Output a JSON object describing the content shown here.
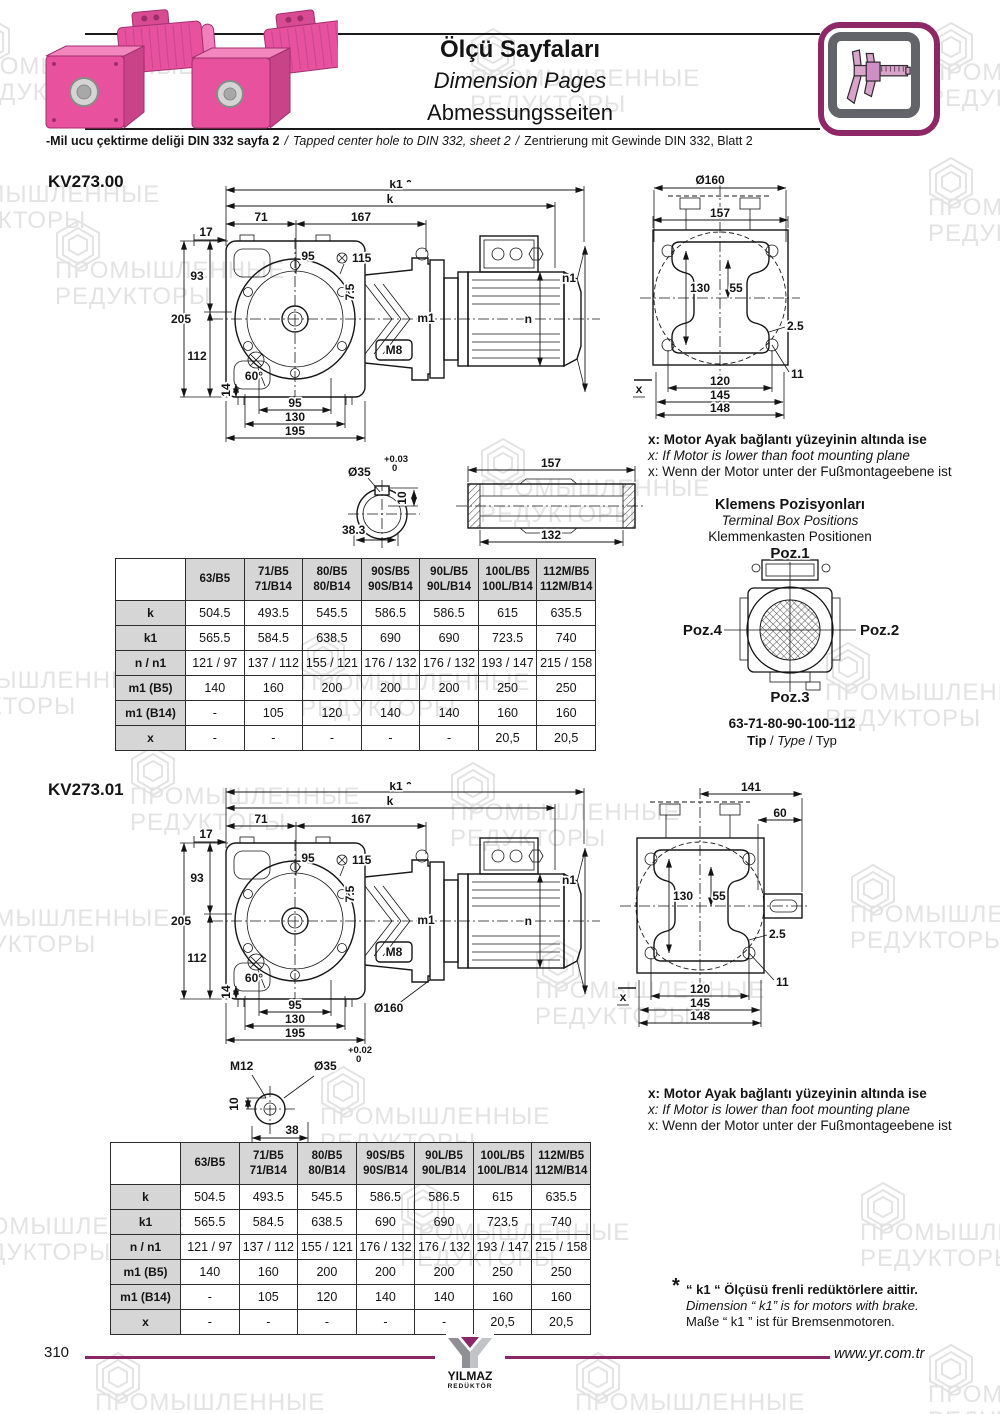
{
  "header": {
    "title_tr": "Ölçü Sayfaları",
    "title_en": "Dimension Pages",
    "title_de": "Abmessungsseiten",
    "note_tr": "-Mil ucu çektirme deliği DIN 332 sayfa 2",
    "note_en": "Tapped center hole to DIN 332, sheet 2",
    "note_de": "Zentrierung mit Gewinde DIN 332, Blatt 2",
    "sep": "/"
  },
  "watermark": {
    "line1": "ПРОМЫШЛЕННЫЕ",
    "line2": "РЕДУКТОРЫ"
  },
  "models": {
    "kv00": {
      "name": "KV273.00",
      "side": {
        "k1": "k1",
        "star": "*",
        "k": "k",
        "d17": "17",
        "d71": "71",
        "d167": "167",
        "d95": "95",
        "d115": "115",
        "d93": "93",
        "d205": "205",
        "d112": "112",
        "d60": "60°",
        "d7_5": "7.5",
        "m8": "M8",
        "m1": "m1",
        "n": "n",
        "n1": "n1",
        "d14": "14",
        "d95b": "95",
        "d130": "130",
        "d195": "195"
      },
      "front": {
        "dia": "Ø160",
        "d157": "157",
        "d130": "130",
        "d55": "55",
        "d2_5": "2.5",
        "d11": "11",
        "d120": "120",
        "d145": "145",
        "d148": "148",
        "x": "x"
      },
      "shaft": {
        "tol_hi": "+0.03",
        "tol_lo": "0",
        "dia": "Ø35",
        "d10": "10",
        "d38": "38.3",
        "d157": "157",
        "d132": "132"
      }
    },
    "kv01": {
      "name": "KV273.01",
      "side": {
        "k1": "k1",
        "star": "*",
        "k": "k",
        "d17": "17",
        "d71": "71",
        "d167": "167",
        "d95": "95",
        "d115": "115",
        "d93": "93",
        "d205": "205",
        "d112": "112",
        "d60": "60°",
        "d7_5": "7.5",
        "m8": "M8",
        "m1": "m1",
        "n": "n",
        "n1": "n1",
        "d14": "14",
        "d95b": "95",
        "d130": "130",
        "d195": "195",
        "dia": "Ø160"
      },
      "front": {
        "d141": "141",
        "d60": "60",
        "d130": "130",
        "d55": "55",
        "d2_5": "2.5",
        "d11": "11",
        "d120": "120",
        "d145": "145",
        "d148": "148",
        "x": "x"
      },
      "shaft": {
        "m12": "M12",
        "tol_hi": "+0.02",
        "tol_lo": "0",
        "dia": "Ø35",
        "d10": "10",
        "d38": "38"
      }
    }
  },
  "motor_note": {
    "tr": "x: Motor Ayak bağlantı yüzeyinin altında ise",
    "en": "x: If Motor is lower than foot mounting plane",
    "de": "x: Wenn der Motor unter der Fußmontageebene ist"
  },
  "terminal_box": {
    "title_tr": "Klemens Pozisyonları",
    "title_en": "Terminal Box Positions",
    "title_de": "Klemmenkasten Positionen",
    "poz1": "Poz.1",
    "poz2": "Poz.2",
    "poz3": "Poz.3",
    "poz4": "Poz.4",
    "sizes": "63-71-80-90-100-112",
    "tip_tr": "Tip",
    "tip_en": "Type",
    "tip_de": "Typ",
    "sep": "/"
  },
  "dim_table": {
    "corner": "",
    "columns": [
      {
        "l1": "63/B5",
        "l2": ""
      },
      {
        "l1": "71/B5",
        "l2": "71/B14"
      },
      {
        "l1": "80/B5",
        "l2": "80/B14"
      },
      {
        "l1": "90S/B5",
        "l2": "90S/B14"
      },
      {
        "l1": "90L/B5",
        "l2": "90L/B14"
      },
      {
        "l1": "100L/B5",
        "l2": "100L/B14"
      },
      {
        "l1": "112M/B5",
        "l2": "112M/B14"
      }
    ],
    "rows": [
      {
        "label": "k",
        "values": [
          "504.5",
          "493.5",
          "545.5",
          "586.5",
          "586.5",
          "615",
          "635.5"
        ]
      },
      {
        "label": "k1",
        "values": [
          "565.5",
          "584.5",
          "638.5",
          "690",
          "690",
          "723.5",
          "740"
        ]
      },
      {
        "label": "n / n1",
        "values": [
          "121 / 97",
          "137 / 112",
          "155 / 121",
          "176 / 132",
          "176 / 132",
          "193 / 147",
          "215 / 158"
        ]
      },
      {
        "label": "m1 (B5)",
        "values": [
          "140",
          "160",
          "200",
          "200",
          "200",
          "250",
          "250"
        ]
      },
      {
        "label": "m1 (B14)",
        "values": [
          "-",
          "105",
          "120",
          "140",
          "140",
          "160",
          "160"
        ]
      },
      {
        "label": "x",
        "values": [
          "-",
          "-",
          "-",
          "-",
          "-",
          "20,5",
          "20,5"
        ]
      }
    ]
  },
  "footnote": {
    "star": "*",
    "tr": "“ k1 “ Ölçüsü frenli redüktörlere aittir.",
    "en": "Dimension “ k1” is for motors with brake.",
    "de": "Maße “ k1 ” ist für Bremsenmotoren."
  },
  "footer": {
    "page": "310",
    "brand": "YILMAZ",
    "brand_sub": "REDÜKTÖR",
    "site": "www.yr.com.tr"
  }
}
